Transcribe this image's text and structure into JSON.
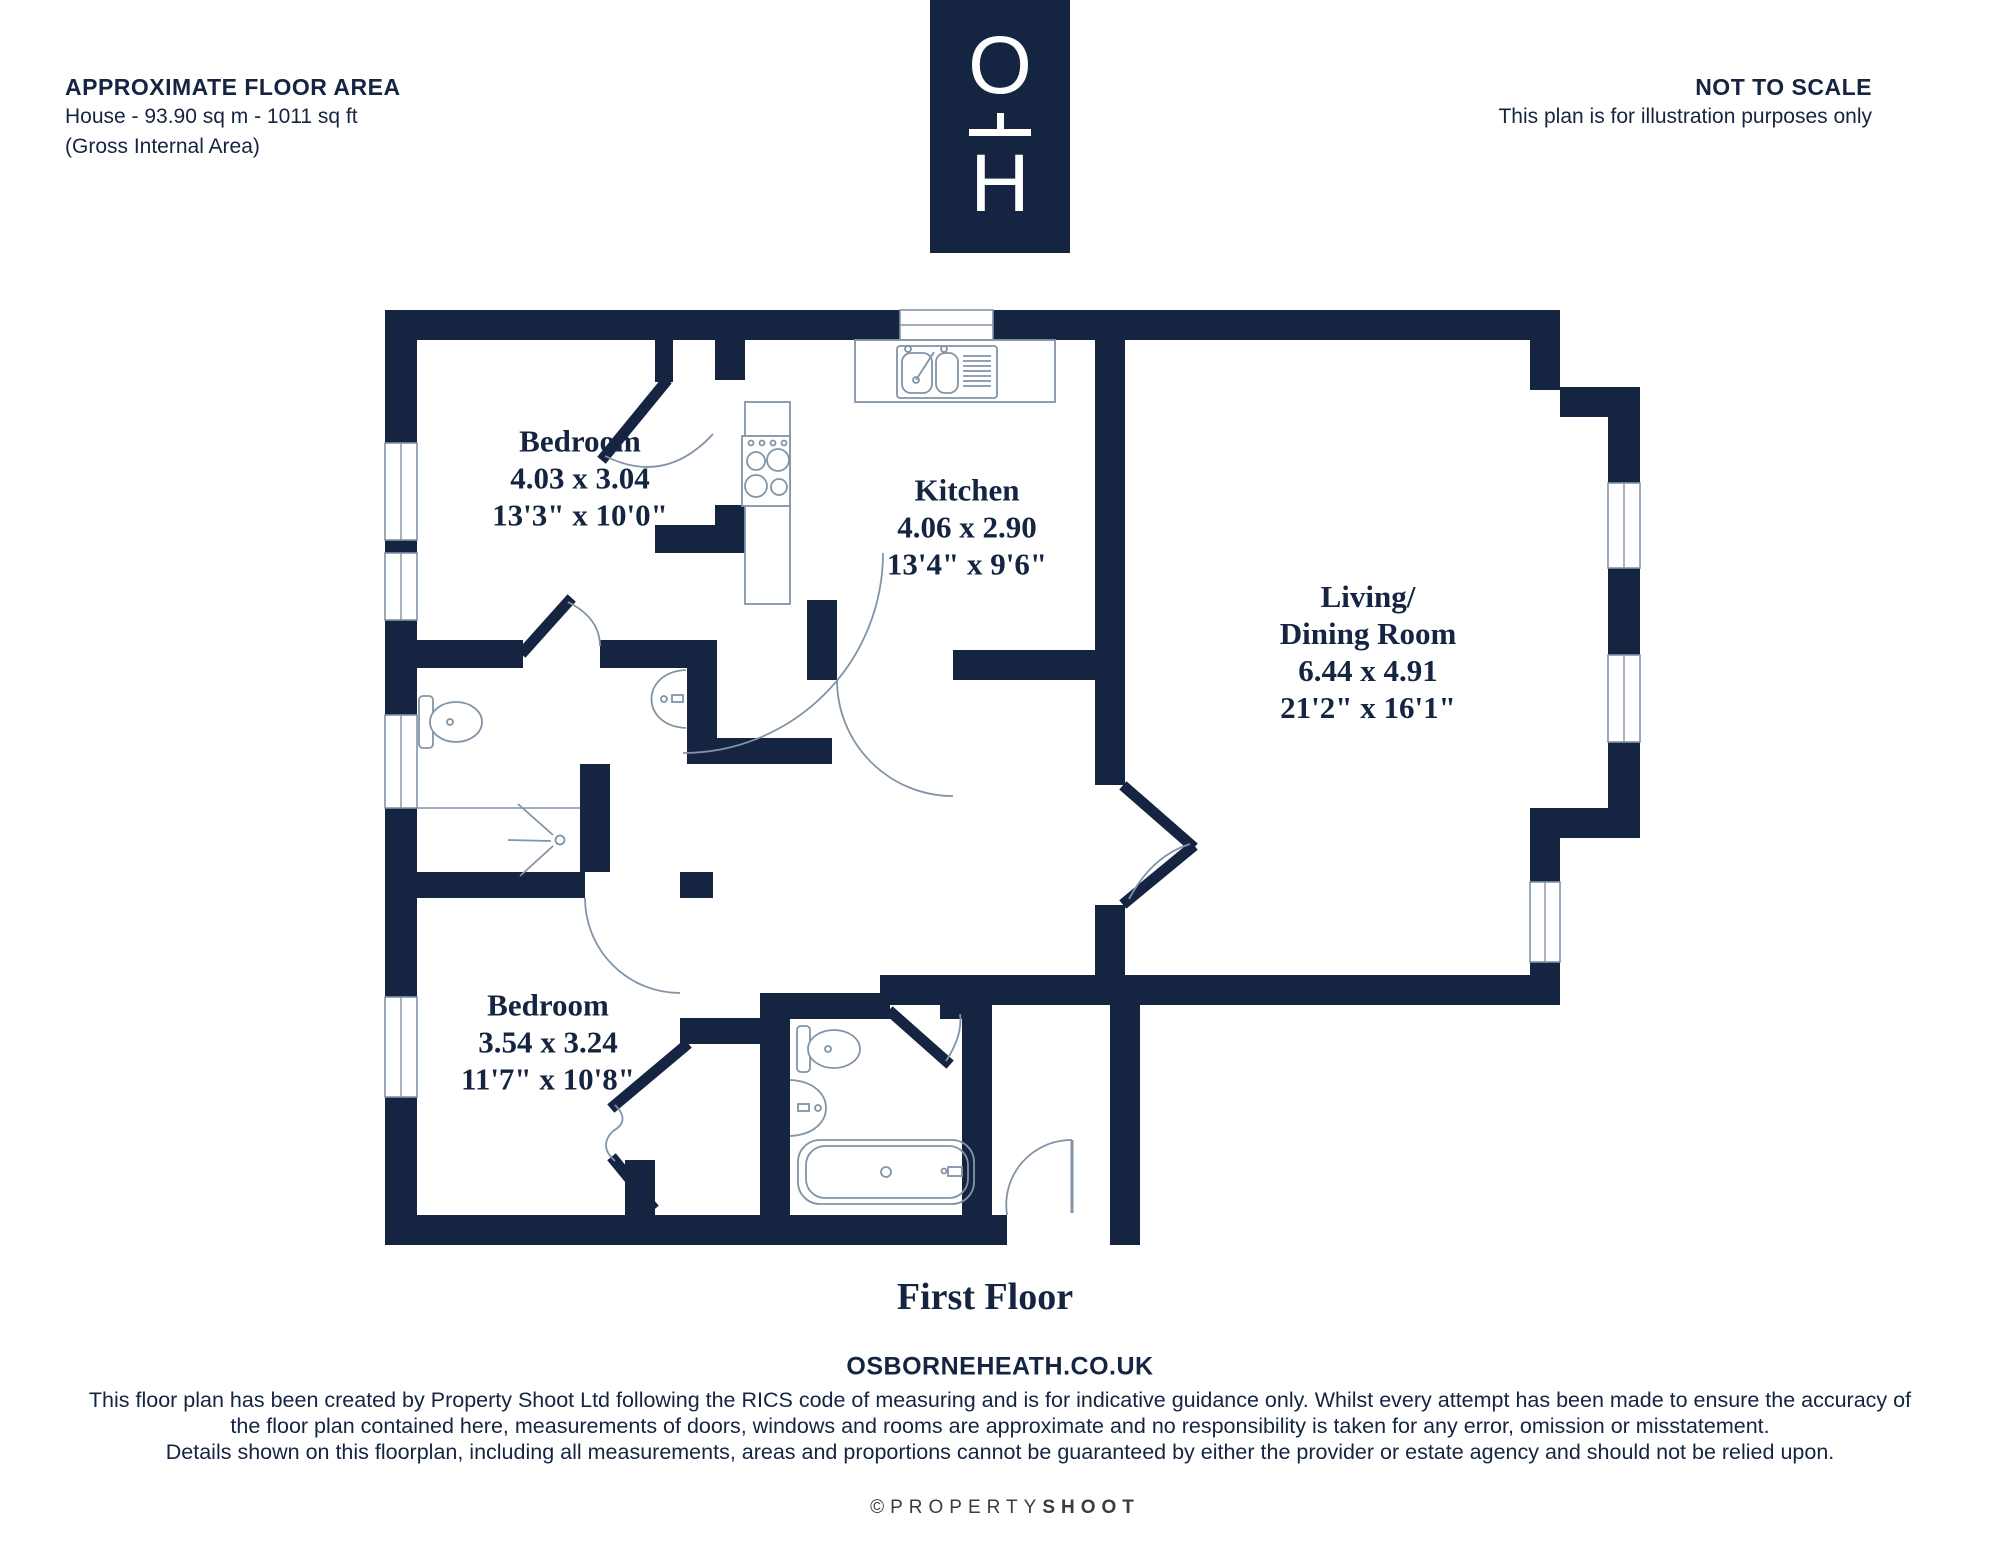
{
  "header": {
    "floor_area_title": "APPROXIMATE FLOOR AREA",
    "floor_area_line1": "House - 93.90 sq m - 1011 sq ft",
    "floor_area_line2": "(Gross Internal Area)",
    "scale_title": "NOT TO SCALE",
    "scale_line": "This plan is for illustration purposes only"
  },
  "logo": {
    "top_letter": "O",
    "bottom_letter": "H"
  },
  "rooms": [
    {
      "name": "Bedroom",
      "metric": "4.03 x 3.04",
      "imperial": "13'3\" x 10'0\""
    },
    {
      "name": "Kitchen",
      "metric": "4.06 x 2.90",
      "imperial": "13'4\" x 9'6\""
    },
    {
      "name1": "Living/",
      "name2": "Dining Room",
      "metric": "6.44 x 4.91",
      "imperial": "21'2\" x 16'1\""
    },
    {
      "name": "Bedroom",
      "metric": "3.54 x 3.24",
      "imperial": "11'7\" x 10'8\""
    }
  ],
  "plan": {
    "floor_label": "First Floor"
  },
  "footer": {
    "website": "OSBORNEHEATH.CO.UK",
    "disclaimer_line1": "This floor plan has been created by Property Shoot Ltd following the RICS code of measuring and is for indicative guidance only. Whilst every attempt has been made to ensure the accuracy of",
    "disclaimer_line2": "the floor plan contained here, measurements of doors, windows and rooms are approximate and no responsibility is taken for any error, omission or misstatement.",
    "disclaimer_line3": "Details shown on this floorplan, including all measurements, areas and proportions cannot be guaranteed by either the provider or estate agency and should not be relied upon.",
    "copyright_symbol": "©",
    "copyright_light": "PROPERTY",
    "copyright_bold": "SHOOT"
  },
  "colors": {
    "wall_navy": "#152440",
    "fixture_line": "#8194a7",
    "copyright_gray": "#3c3c3c"
  }
}
